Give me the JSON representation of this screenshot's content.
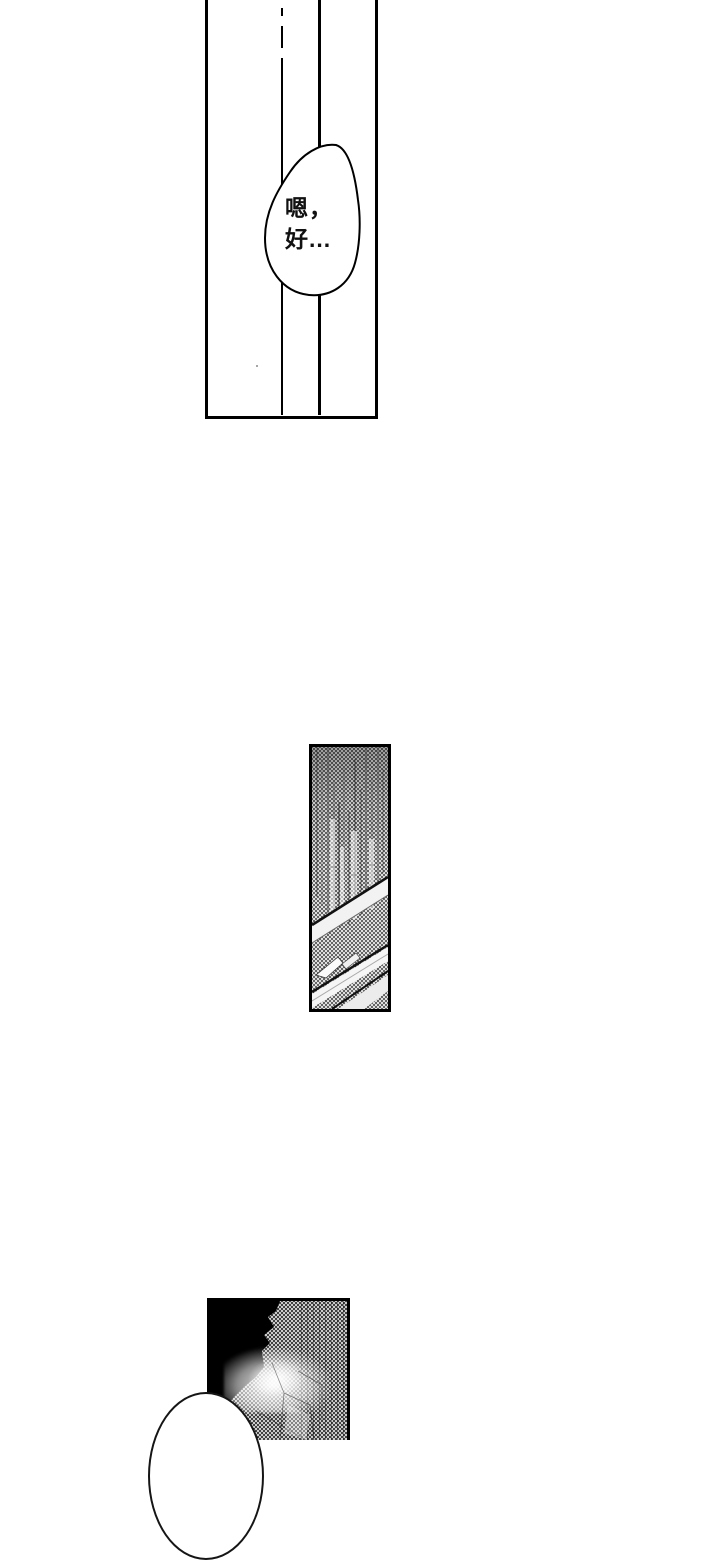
{
  "page": {
    "width": 720,
    "height": 1440,
    "paper_color": "#ffffff",
    "ink_color": "#000000",
    "tone_color": "#c9c9c9"
  },
  "speech_bubble": {
    "line1": "嗯，",
    "line2": "好..."
  },
  "panels": [
    {
      "id": "panel-hallway",
      "alt": "tall white panel, vertical wall lines, speech bubble"
    },
    {
      "id": "panel-building",
      "alt": "narrow screentone panel, building facade with diagonal railings"
    },
    {
      "id": "panel-night",
      "alt": "dark panel, black silhouette against screentone, head entering from bottom"
    }
  ]
}
